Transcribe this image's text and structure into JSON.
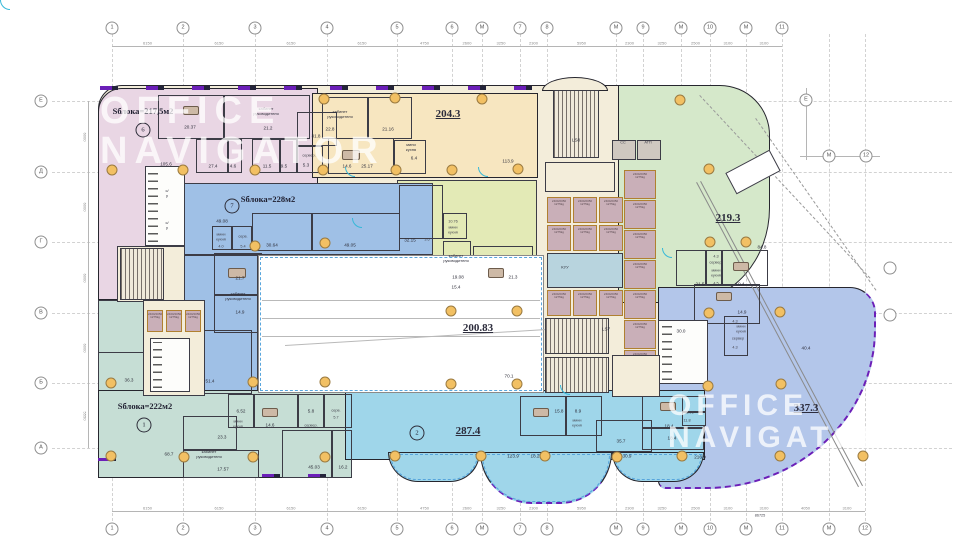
{
  "watermark": {
    "line1": "OFFICE",
    "line2": "NAVIGATOR"
  },
  "colors": {
    "accent_purple": "#6b1fb8",
    "door_cyan": "#35b8d8",
    "column_fill": "#f2c063",
    "zone_pink": "#e9d6e4",
    "zone_orange": "#f7e6c0",
    "zone_green": "#d5e8ca",
    "zone_yellowgreen": "#e3eab6",
    "zone_blue": "#9fc0e6",
    "zone_teal": "#c6ded5",
    "zone_cyan": "#9fd6ea",
    "zone_periwinkle": "#b3c6ea"
  },
  "zones": [
    {
      "id": "block6",
      "label": "Sблока=217,5м2",
      "number": "6"
    },
    {
      "id": "block7",
      "label": "Sблока=228м2",
      "number": "7"
    },
    {
      "id": "block1",
      "label": "Sблока=222м2",
      "number": "1"
    },
    {
      "id": "block2",
      "area": "287.4",
      "number": "2"
    },
    {
      "id": "zone204",
      "area": "204.3"
    },
    {
      "id": "zone219",
      "area": "219.3"
    },
    {
      "id": "zone200",
      "area": "200.83"
    },
    {
      "id": "zone337",
      "area": "337.3"
    }
  ],
  "core": {
    "stair_top": "LS8",
    "stair_mid": "LS7",
    "room_cc": "CC",
    "room_atp": "АТП",
    "room_kuu": "КУУ",
    "lift_cell": "2400/2050\n1275kg"
  },
  "grid": {
    "cols": [
      {
        "l": "1",
        "x": 112
      },
      {
        "l": "2",
        "x": 183
      },
      {
        "l": "3",
        "x": 255
      },
      {
        "l": "4",
        "x": 327
      },
      {
        "l": "5",
        "x": 397
      },
      {
        "l": "6",
        "x": 452
      },
      {
        "l": "М",
        "x": 482
      },
      {
        "l": "7",
        "x": 520
      },
      {
        "l": "8",
        "x": 547
      },
      {
        "l": "М",
        "x": 616
      },
      {
        "l": "9",
        "x": 643
      },
      {
        "l": "М",
        "x": 681
      },
      {
        "l": "10",
        "x": 710
      },
      {
        "l": "М",
        "x": 746
      },
      {
        "l": "11",
        "x": 782
      },
      {
        "l": "М",
        "x": 829,
        "top": false
      },
      {
        "l": "12",
        "x": 865,
        "top": false
      }
    ],
    "rows": [
      {
        "l": "Е",
        "y": 101
      },
      {
        "l": "Д",
        "y": 172
      },
      {
        "l": "Г",
        "y": 242
      },
      {
        "l": "В",
        "y": 313
      },
      {
        "l": "Б",
        "y": 383
      },
      {
        "l": "А",
        "y": 448
      }
    ],
    "extra_bubbles": [
      {
        "l": "Е",
        "x": 806,
        "y": 100
      },
      {
        "l": "М",
        "x": 829,
        "y": 156
      },
      {
        "l": "12",
        "x": 866,
        "y": 156
      },
      {
        "l": "",
        "x": 890,
        "y": 268
      },
      {
        "l": "",
        "x": 890,
        "y": 315
      }
    ]
  },
  "dims": {
    "top": [
      "6150",
      "6150",
      "6150",
      "6150",
      "4750",
      "2600",
      "3250",
      "2300",
      "5950",
      "2300",
      "3250",
      "2500",
      "3100",
      "3100"
    ],
    "bottom": [
      "6150",
      "6150",
      "6150",
      "6150",
      "4750",
      "2600",
      "3250",
      "2300",
      "5950",
      "2300",
      "3250",
      "2500",
      "3100",
      "3100",
      "4050",
      "3100"
    ],
    "left": [
      "6000",
      "6000",
      "6000",
      "6000",
      "5550"
    ],
    "total": "86725"
  },
  "columns": [
    [
      112,
      170
    ],
    [
      183,
      170
    ],
    [
      255,
      170
    ],
    [
      323,
      170
    ],
    [
      396,
      170
    ],
    [
      452,
      170
    ],
    [
      518,
      169
    ],
    [
      324,
      99
    ],
    [
      395,
      98
    ],
    [
      482,
      99
    ],
    [
      680,
      100
    ],
    [
      709,
      169
    ],
    [
      710,
      242
    ],
    [
      746,
      242
    ],
    [
      255,
      246
    ],
    [
      325,
      243
    ],
    [
      451,
      311
    ],
    [
      517,
      311
    ],
    [
      111,
      383
    ],
    [
      253,
      382
    ],
    [
      325,
      382
    ],
    [
      451,
      384
    ],
    [
      517,
      384
    ],
    [
      709,
      313
    ],
    [
      780,
      312
    ],
    [
      708,
      386
    ],
    [
      781,
      384
    ],
    [
      111,
      456
    ],
    [
      184,
      457
    ],
    [
      253,
      457
    ],
    [
      325,
      457
    ],
    [
      395,
      456
    ],
    [
      481,
      456
    ],
    [
      545,
      456
    ],
    [
      617,
      457
    ],
    [
      682,
      456
    ],
    [
      780,
      456
    ],
    [
      863,
      456
    ]
  ],
  "labels": [
    [
      143,
      111,
      "Sблока=217,5м2",
      "b"
    ],
    [
      143,
      130,
      "6",
      "c"
    ],
    [
      268,
      199,
      "Sблока=228м2",
      "b"
    ],
    [
      232,
      206,
      "7",
      "c"
    ],
    [
      145,
      406,
      "Sблока=222м2",
      "b"
    ],
    [
      144,
      425,
      "1",
      "c"
    ],
    [
      417,
      433,
      "2",
      "c"
    ],
    [
      448,
      114,
      "204.3",
      "a"
    ],
    [
      728,
      218,
      "219.3",
      "a"
    ],
    [
      478,
      328,
      "200.83",
      "a"
    ],
    [
      468,
      431,
      "287.4",
      "a"
    ],
    [
      806,
      408,
      "337.3",
      "a"
    ],
    [
      190,
      127,
      "20.37",
      "n"
    ],
    [
      266,
      112,
      "кабинет\nруководителя",
      "r"
    ],
    [
      268,
      128,
      "21.2",
      "n"
    ],
    [
      340,
      115,
      "кабинет\nруководителя",
      "r"
    ],
    [
      330,
      129,
      "22.8",
      "n"
    ],
    [
      388,
      129,
      "21.16",
      "n"
    ],
    [
      411,
      148,
      "мини\nкухня",
      "r"
    ],
    [
      414,
      158,
      "6.4",
      "n"
    ],
    [
      166,
      164,
      "105.6",
      "n"
    ],
    [
      213,
      166,
      "27.4",
      "n"
    ],
    [
      233,
      166,
      "4.6",
      "n"
    ],
    [
      267,
      166,
      "11.5",
      "n"
    ],
    [
      284,
      166,
      "9.5",
      "n"
    ],
    [
      316,
      136,
      "31.8",
      "n"
    ],
    [
      309,
      156,
      "сервер.",
      "t"
    ],
    [
      306,
      165,
      "5.3",
      "n"
    ],
    [
      347,
      166,
      "14.6",
      "n"
    ],
    [
      367,
      166,
      "25.17",
      "n"
    ],
    [
      167,
      194,
      "с/у",
      "r"
    ],
    [
      167,
      226,
      "с/у",
      "r"
    ],
    [
      508,
      161,
      "113.9",
      "n"
    ],
    [
      762,
      247,
      "84.8",
      "n"
    ],
    [
      716,
      257,
      "4.3",
      "t"
    ],
    [
      716,
      263,
      "сервер.",
      "t"
    ],
    [
      716,
      273,
      "мини\nкухня",
      "t"
    ],
    [
      700,
      284,
      "21.5",
      "n"
    ],
    [
      716,
      284,
      "4.5",
      "t"
    ],
    [
      740,
      284,
      "19.4",
      "n"
    ],
    [
      222,
      221,
      "49.08",
      "n"
    ],
    [
      221,
      237,
      "мини\nкухня",
      "t"
    ],
    [
      221,
      247,
      "4.0",
      "t"
    ],
    [
      243,
      237,
      "серв.",
      "t"
    ],
    [
      243,
      247,
      "5.4",
      "t"
    ],
    [
      272,
      245,
      "30.64",
      "n"
    ],
    [
      350,
      245,
      "49.05",
      "n"
    ],
    [
      240,
      278,
      "21.7",
      "n"
    ],
    [
      238,
      297,
      "кабинет\nруководителя",
      "r"
    ],
    [
      240,
      312,
      "14.9",
      "n"
    ],
    [
      210,
      381,
      "51.4",
      "n"
    ],
    [
      410,
      240,
      "32.15",
      "n"
    ],
    [
      427,
      240,
      "3.6",
      "t"
    ],
    [
      453,
      222,
      "10.76",
      "t"
    ],
    [
      453,
      230,
      "мини\nкухня",
      "t"
    ],
    [
      456,
      259,
      "кабинет\nруководителя",
      "r"
    ],
    [
      458,
      277,
      "19.08",
      "n"
    ],
    [
      456,
      287,
      "15.4",
      "n"
    ],
    [
      513,
      277,
      "21.3",
      "n"
    ],
    [
      509,
      376,
      "70.1",
      "n"
    ],
    [
      576,
      140,
      "LS8",
      "n"
    ],
    [
      623,
      143,
      "CC",
      "t"
    ],
    [
      648,
      143,
      "АТП",
      "t"
    ],
    [
      565,
      268,
      "КУУ",
      "r"
    ],
    [
      606,
      329,
      "LS7",
      "n"
    ],
    [
      129,
      380,
      "36.3",
      "n"
    ],
    [
      169,
      454,
      "68.7",
      "n"
    ],
    [
      241,
      411,
      "6.52",
      "n"
    ],
    [
      238,
      424,
      "мини\nкухня",
      "t"
    ],
    [
      270,
      425,
      "14.6",
      "n"
    ],
    [
      311,
      411,
      "5.8",
      "n"
    ],
    [
      311,
      426,
      "сервер.",
      "t"
    ],
    [
      336,
      411,
      "серв.",
      "t"
    ],
    [
      336,
      418,
      "5.7",
      "t"
    ],
    [
      222,
      437,
      "23.3",
      "n"
    ],
    [
      209,
      455,
      "кабинет\nруководителя",
      "r"
    ],
    [
      223,
      469,
      "17.57",
      "n"
    ],
    [
      314,
      467,
      "45.03",
      "n"
    ],
    [
      343,
      467,
      "16.2",
      "n"
    ],
    [
      559,
      411,
      "15.8",
      "n"
    ],
    [
      578,
      411,
      "8.9",
      "n"
    ],
    [
      577,
      423,
      "мини\nкухня",
      "t"
    ],
    [
      621,
      441,
      "35.7",
      "n"
    ],
    [
      513,
      456,
      "123.9",
      "n"
    ],
    [
      535,
      456,
      "18.2",
      "n"
    ],
    [
      627,
      456,
      "30.9",
      "n"
    ],
    [
      669,
      426,
      "18.4",
      "n"
    ],
    [
      672,
      438,
      "18.4",
      "n"
    ],
    [
      689,
      413,
      "13.06",
      "t"
    ],
    [
      687,
      421,
      "11.8",
      "t"
    ],
    [
      742,
      312,
      "14.9",
      "n"
    ],
    [
      735,
      322,
      "4.3",
      "t"
    ],
    [
      741,
      329,
      "мини\nкухня",
      "t"
    ],
    [
      738,
      339,
      "сервер",
      "t"
    ],
    [
      735,
      348,
      "4.3",
      "t"
    ],
    [
      681,
      331,
      "30.0",
      "n"
    ],
    [
      806,
      348,
      "40.4",
      "n"
    ],
    [
      700,
      457,
      "216.9",
      "n"
    ],
    [
      760,
      516,
      "86725",
      "t"
    ]
  ]
}
